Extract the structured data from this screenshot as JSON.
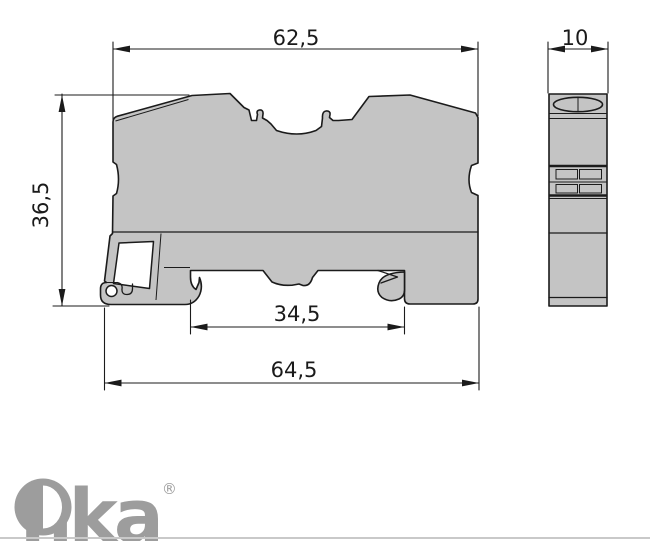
{
  "dimensions": {
    "top_width": "62,5",
    "depth": "10",
    "height": "36,5",
    "slot_width": "34,5",
    "total_width": "64,5"
  },
  "logo": {
    "name": "Onka",
    "mark": "O",
    "rest": "nka",
    "registered": "®"
  },
  "views": {
    "front": "terminal-block-front-profile",
    "side": "terminal-block-side-profile"
  },
  "colors": {
    "body_fill": "#c4c4c4",
    "outline": "#1b1b1b",
    "text": "#1a1a1a",
    "logo": "#9d9d9d",
    "footer_rule": "#c9c9c9",
    "background": "#ffffff"
  }
}
